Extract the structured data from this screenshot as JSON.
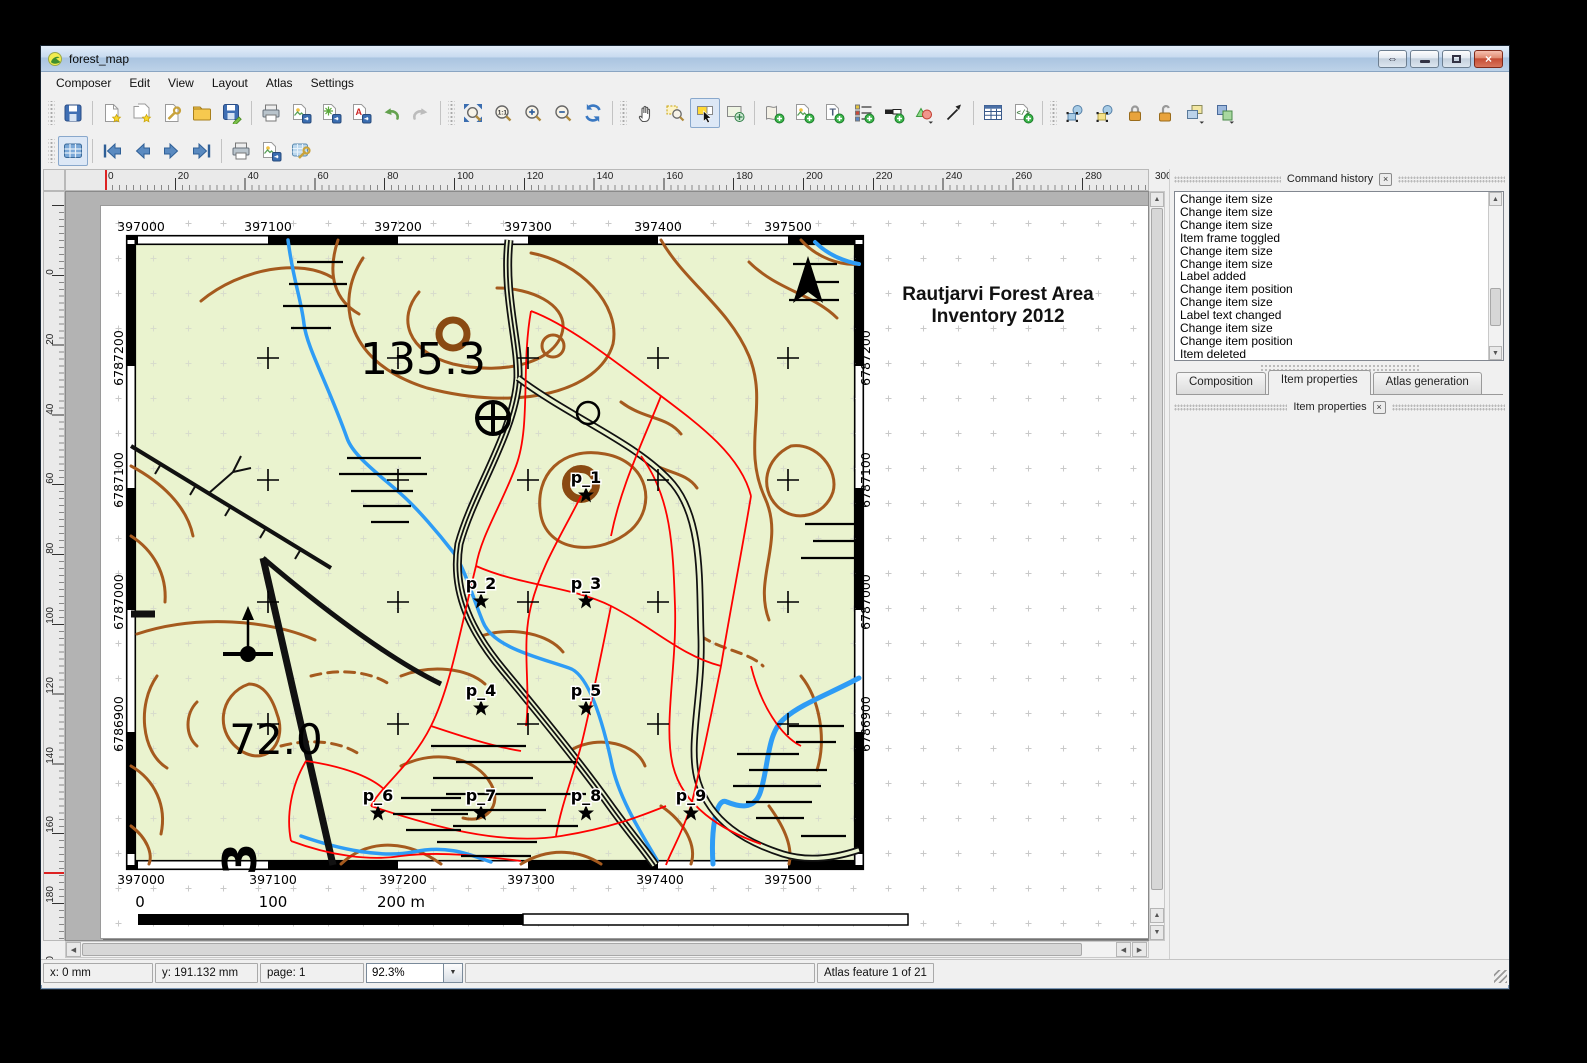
{
  "window": {
    "title": "forest_map"
  },
  "menu": {
    "items": [
      "Composer",
      "Edit",
      "View",
      "Layout",
      "Atlas",
      "Settings"
    ]
  },
  "toolbar_main": {
    "icons": [
      "save-project",
      "new-composer",
      "duplicate-composer",
      "composer-manager",
      "open-template",
      "save-as-template",
      "print",
      "export-as-image",
      "export-as-svg",
      "export-as-pdf",
      "undo",
      "redo",
      "zoom-full",
      "zoom-1-1",
      "zoom-in",
      "zoom-out",
      "refresh-view",
      "pan",
      "zoom-region",
      "select-move-item",
      "move-item-content",
      "add-new-map",
      "add-image",
      "add-label",
      "add-legend",
      "add-scalebar",
      "add-basic-shape",
      "add-arrow",
      "add-attribute-table",
      "add-html-frame",
      "select-all-items",
      "invert-selection",
      "lock-selected-items",
      "unlock-all-items",
      "group-items",
      "raise-selected-items"
    ]
  },
  "toolbar_atlas": {
    "icons": [
      "preview-atlas",
      "first-feature",
      "previous-feature",
      "next-feature",
      "last-feature",
      "print-atlas",
      "export-atlas-as-image",
      "atlas-settings"
    ]
  },
  "rulers": {
    "horizontal": [
      "0",
      "20",
      "40",
      "60",
      "80",
      "100",
      "120",
      "140",
      "160",
      "180",
      "200",
      "220",
      "240",
      "260",
      "280",
      "300"
    ],
    "vertical": [
      "0",
      "20",
      "40",
      "60",
      "80",
      "100",
      "120",
      "140",
      "160",
      "180",
      "200"
    ]
  },
  "page": {
    "map": {
      "title": [
        "Rautjarvi Forest Area",
        "Inventory 2012"
      ],
      "top_coords": [
        "397000",
        "397100",
        "397200",
        "397300",
        "397400",
        "397500"
      ],
      "bottom_coords": [
        "397000",
        "397100",
        "397200",
        "397300",
        "397400",
        "397500"
      ],
      "left_coords": [
        "6787200",
        "6787100",
        "6787000",
        "6786900"
      ],
      "right_coords": [
        "6787200",
        "6787100",
        "6787000",
        "6786900"
      ],
      "elevations": [
        "135.3",
        "72.0",
        "3"
      ],
      "points": [
        {
          "label": "p_1"
        },
        {
          "label": "p_2"
        },
        {
          "label": "p_3"
        },
        {
          "label": "p_4"
        },
        {
          "label": "p_5"
        },
        {
          "label": "p_6"
        },
        {
          "label": "p_7"
        },
        {
          "label": "p_8"
        },
        {
          "label": "p_9"
        }
      ],
      "scalebar": {
        "labels": [
          "0",
          "100",
          "200 m"
        ]
      },
      "colors": {
        "background": "#eaf3cf",
        "contours": "#a55a1e",
        "contours_index": "#8a4a12",
        "streams": "#2e9cf5",
        "stand_boundaries": "#ff0000",
        "roads": "#111111"
      }
    }
  },
  "command_history": {
    "title": "Command history",
    "items": [
      "Change item size",
      "Change item size",
      "Change item size",
      "Item frame toggled",
      "Change item size",
      "Change item size",
      "Label added",
      "Change item position",
      "Change item size",
      "Label text changed",
      "Change item size",
      "Change item position",
      "Item deleted",
      "Item deleted"
    ]
  },
  "panel_tabs": {
    "items": [
      "Composition",
      "Item properties",
      "Atlas generation"
    ],
    "active": "Item properties"
  },
  "item_properties": {
    "title": "Item properties"
  },
  "statusbar": {
    "x": "x: 0 mm",
    "y": "y: 191.132 mm",
    "page": "page: 1",
    "zoom": "92.3%",
    "atlas": "Atlas feature 1 of 21"
  }
}
